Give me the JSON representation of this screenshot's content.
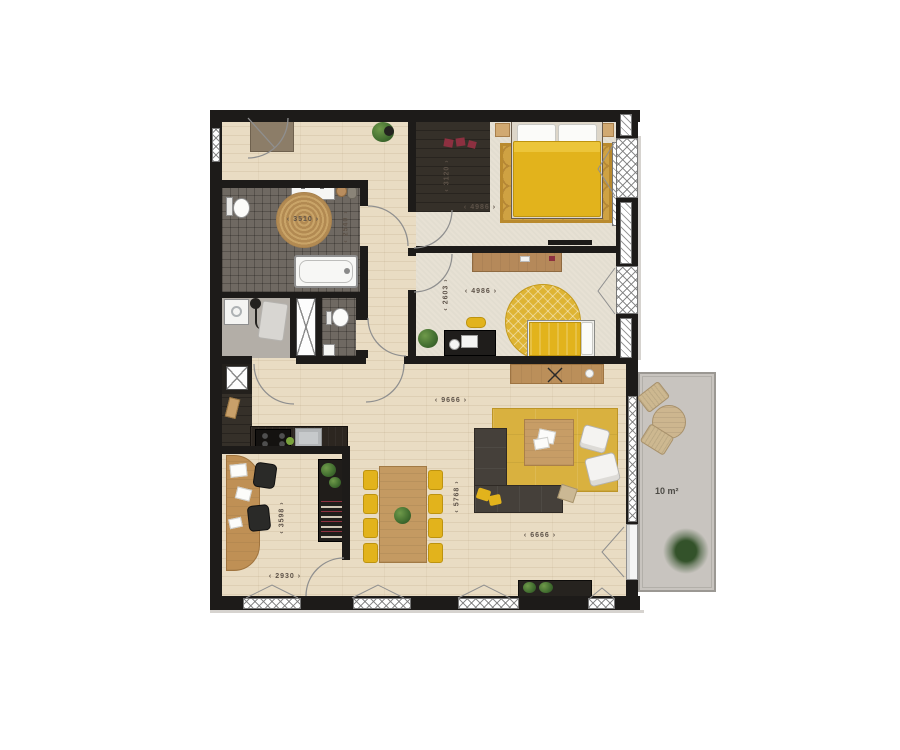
{
  "labels": {
    "bathroom_width": "3510",
    "bathroom_depth": "2540",
    "bedroom1_width": "4986",
    "bedroom1_depth": "3120",
    "bedroom2_width": "4986",
    "bedroom2_depth": "2603",
    "living_width_upper": "9666",
    "living_depth": "5768",
    "living_width_lower": "6666",
    "office_depth": "3598",
    "office_width": "2930",
    "balcony_area": "10 m²"
  },
  "colors": {
    "wall": "#1d1b19",
    "wood_floor": "#e9dcc3",
    "carpet": "#e7e1d4",
    "bath_tile": "#6f6962",
    "dark_floor": "#353029",
    "utility_floor": "#b3aea7",
    "balcony_floor": "#c8c4bf",
    "accent_yellow": "#e2b31c",
    "rug_gold": "#cfa243",
    "rug_patch": "#d9b13f",
    "sofa": "#45403a",
    "counter": "#2c2620",
    "wood_furniture": "#c49a62",
    "dim_text": "#5d5248"
  },
  "icons": {
    "fan_icon": "crossed X lines",
    "window_opening_icon": "open triangle",
    "door_swing_icon": "quarter-circle arc"
  }
}
